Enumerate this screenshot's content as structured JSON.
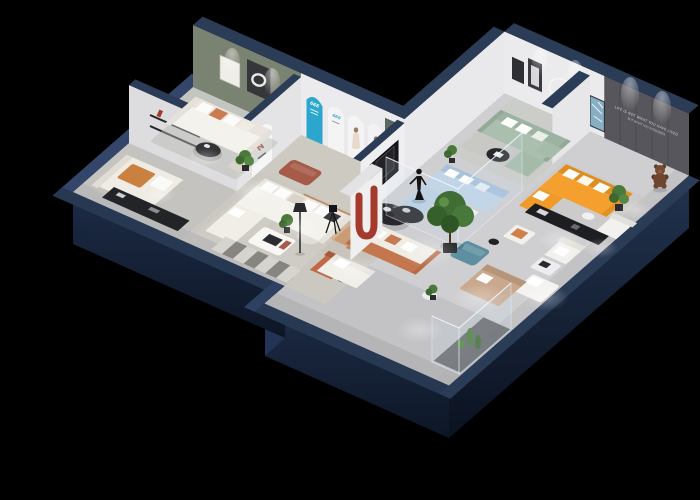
{
  "scene": {
    "title": "3D Isometric Furniture Showroom Floor Plan",
    "background": "#000000",
    "quote": {
      "line1": "LIFE IS NOT WHAT YOU HAVE LIVED",
      "line2": "BUT WHAT YOU REMEMBER"
    },
    "arch_label": "666",
    "display_glyph": "N",
    "colors": {
      "background": "#000000",
      "wall_navy_top": "#2b3c57",
      "wall_navy_face": "#1c2a42",
      "wall_white": "#ebebed",
      "wall_olive": "#7a8371",
      "wall_dark_gray": "#56565c",
      "floor_light": "#c8c8ca",
      "accent_cyan": "#2ba6cc",
      "accent_red": "#a33a2c",
      "door_green": "#5c6b5c",
      "sofa_white": "#f4f2ec",
      "sofa_tan": "#cb9c74",
      "sofa_orange": "#f5a02e",
      "sofa_sage": "#aabfae",
      "sofa_blue": "#c1d5e8",
      "sofa_terracotta": "#c4764f",
      "teal_ottoman": "#5d8fa0",
      "plant_green": "#4a7a3a",
      "table_black": "#28282c",
      "bear_brown": "#6e452e"
    },
    "rooms": [
      {
        "name": "green-accent-lounge",
        "furniture": [
          "white-sofa-orange-pillows",
          "round-black-coffee-table",
          "wall-frames",
          "potted-plant"
        ]
      },
      {
        "name": "display-corridor",
        "furniture": [
          "cyan-arch-panel",
          "arched-poster-panels",
          "terracotta-ottoman",
          "green-door"
        ]
      },
      {
        "name": "tan-sofa-lounge",
        "furniture": [
          "tan-sofa",
          "tan-armchair",
          "white-coffee-table",
          "potted-plant"
        ]
      },
      {
        "name": "daybed-room",
        "furniture": [
          "daybed-orange-cushion",
          "black-media-console",
          "wall-shelves"
        ]
      },
      {
        "name": "central-lounge",
        "furniture": [
          "white-l-sofa",
          "white-coffee-table",
          "orange-accent-chair",
          "floor-lamp",
          "striped-mat",
          "camera-tripod"
        ]
      },
      {
        "name": "dining-nook",
        "furniture": [
          "black-oval-dining-table",
          "white-chairs",
          "mannequin-sculpture",
          "black-frame-art",
          "red-u-display-wall",
          "large-potted-tree"
        ]
      },
      {
        "name": "sage-lounge",
        "furniture": [
          "sage-sofa",
          "black-round-coffee-table",
          "sage-ottoman",
          "teal-abstract-art"
        ]
      },
      {
        "name": "orange-sofa-lounge",
        "furniture": [
          "orange-l-sofa",
          "black-console-table",
          "white-armchair",
          "teddy-bear-figure",
          "quote-wall"
        ]
      },
      {
        "name": "glass-meeting-room",
        "furniture": [
          "light-blue-sectional",
          "white-coffee-table"
        ]
      },
      {
        "name": "south-gallery",
        "furniture": [
          "terracotta-white-sofa",
          "black-oval-table",
          "teal-ottoman",
          "tan-chaise",
          "glass-plant-display",
          "white-loveseat"
        ]
      }
    ]
  }
}
